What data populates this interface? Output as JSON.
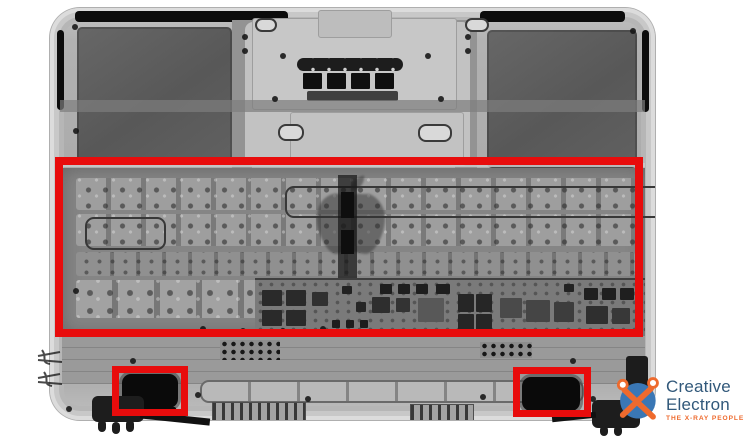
{
  "image": {
    "description_colors": {
      "background": "#ffffff",
      "xray_body_gray": "#a9a9a9",
      "battery_gray": "#5d5d5d"
    }
  },
  "annotations": {
    "color": "#e80c0c",
    "boxes": [
      {
        "name": "keyboard-region-highlight"
      },
      {
        "name": "left-speaker-highlight"
      },
      {
        "name": "right-speaker-highlight"
      }
    ]
  },
  "logo": {
    "line1": "Creative",
    "line2": "Electron",
    "tagline": "THE X-RAY PEOPLE",
    "blue": "#3a77b5",
    "navy": "#31587a",
    "orange": "#ee6a2d"
  }
}
